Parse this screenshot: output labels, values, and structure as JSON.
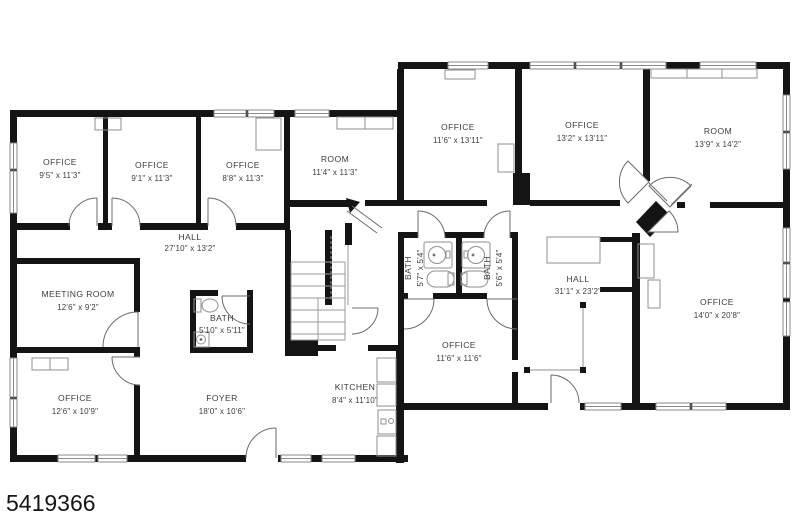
{
  "watermark": "5419366",
  "colors": {
    "wall": "#141414",
    "door_line": "#6b6b6b",
    "furniture_line": "#8f8f8f",
    "label": "#3d3d3d",
    "background": "#ffffff"
  },
  "rooms": [
    {
      "key": "office-a",
      "name": "OFFICE",
      "dims": "9'5\" x 11'3\""
    },
    {
      "key": "office-b",
      "name": "OFFICE",
      "dims": "9'1\" x 11'3\""
    },
    {
      "key": "office-c",
      "name": "OFFICE",
      "dims": "8'8\" x 11'3\""
    },
    {
      "key": "room-a",
      "name": "ROOM",
      "dims": "11'4\" x 11'3\""
    },
    {
      "key": "office-d",
      "name": "OFFICE",
      "dims": "11'6\" x 13'11\""
    },
    {
      "key": "office-e",
      "name": "OFFICE",
      "dims": "13'2\" x 13'11\""
    },
    {
      "key": "room-b",
      "name": "ROOM",
      "dims": "13'9\" x 14'2\""
    },
    {
      "key": "hall-a",
      "name": "HALL",
      "dims": "27'10\" x 13'2\""
    },
    {
      "key": "meeting-room",
      "name": "MEETING ROOM",
      "dims": "12'6\" x 9'2\""
    },
    {
      "key": "bath-a",
      "name": "BATH",
      "dims": "5'10\" x 5'11\""
    },
    {
      "key": "bath-b",
      "name": "BATH",
      "dims": "5'7\" x 5'4\""
    },
    {
      "key": "bath-c",
      "name": "BATH",
      "dims": "5'6\" x 5'4\""
    },
    {
      "key": "hall-b",
      "name": "HALL",
      "dims": "31'1\" x 23'2\""
    },
    {
      "key": "office-f",
      "name": "OFFICE",
      "dims": "11'6\" x 11'6\""
    },
    {
      "key": "office-g",
      "name": "OFFICE",
      "dims": "14'0\" x 20'8\""
    },
    {
      "key": "office-h",
      "name": "OFFICE",
      "dims": "12'6\" x 10'9\""
    },
    {
      "key": "foyer",
      "name": "FOYER",
      "dims": "18'0\" x 10'6\""
    },
    {
      "key": "kitchen",
      "name": "KITCHEN",
      "dims": "8'4\" x 11'10\""
    }
  ]
}
